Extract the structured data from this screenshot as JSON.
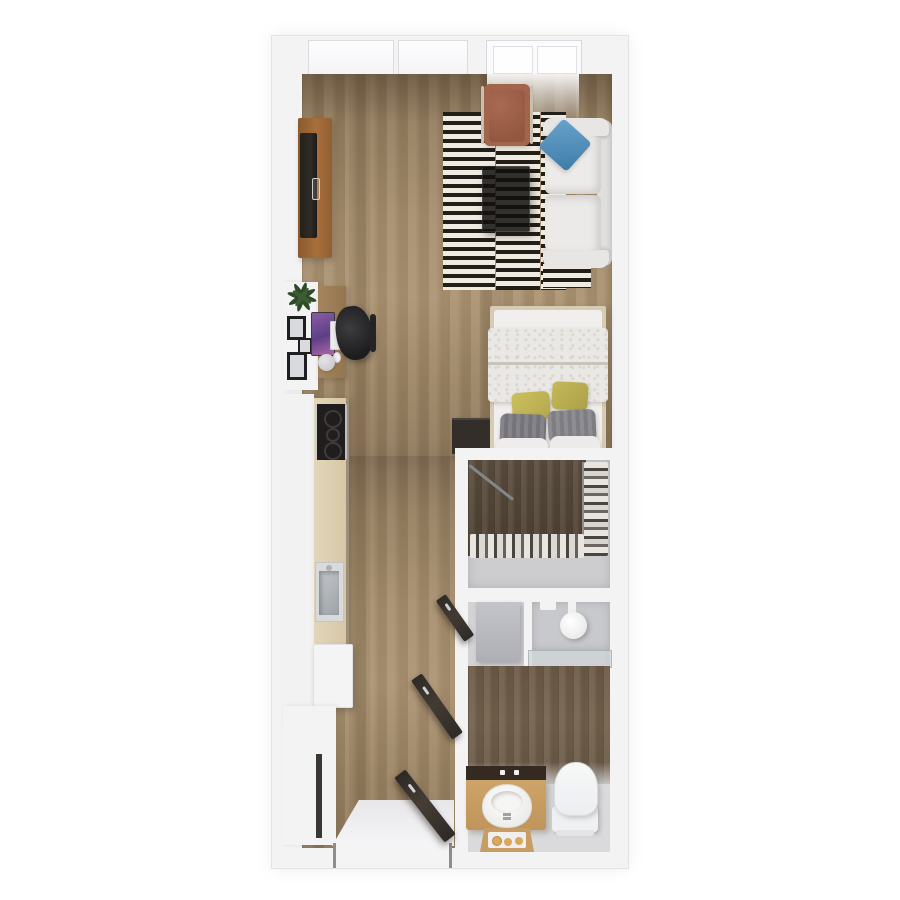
{
  "scene": {
    "kind": "3d-floor-plan-top-view",
    "description": "Top-down 3D render of a narrow studio apartment with living/sleeping area, galley kitchen, walk-in closet, bathroom and entry hall",
    "no_visible_text": true
  },
  "palette": {
    "background": "#ffffff",
    "wall": "#f4f3f4",
    "wood_floor_light": "#a08a6a",
    "wood_floor_closet": "#574a3c",
    "wood_floor_bath": "#6f5e4a",
    "gray_floor": "#d8d8da",
    "rug_stripe_dark": "#211d1a",
    "rug_stripe_light": "#f0ebe0",
    "sofa_white": "#eae9e7",
    "pillow_blue": "#5b9ac7",
    "armchair_terracotta": "#a3644c",
    "tv_console_wood": "#9c6434",
    "door_dark_brown": "#39322c",
    "vanity_wood": "#c89d63",
    "pillow_yellow": "#c0b456",
    "pillow_gray": "#85858a",
    "monitor_purple": "#7a54a0",
    "kitchen_counter_wood": "#dccdaf",
    "cooktop_black": "#201e1d",
    "washer_gray": "#b9bac0",
    "shower_tile": "#c8c9cc"
  },
  "rooms": [
    {
      "name": "living-sleeping-area",
      "items": [
        "tv-console",
        "tv",
        "black-white-striped-rug",
        "glass-coffee-table",
        "white-sofa",
        "blue-throw-pillow",
        "terracotta-armchair",
        "white-desk",
        "wood-desk-top",
        "purple-monitor",
        "white-keyboard",
        "black-office-chair",
        "desk-lamp",
        "picture-frames",
        "houseplant",
        "double-bed",
        "textured-duvet",
        "yellow-pillows",
        "gray-pillows",
        "white-pillows",
        "dark-nightstand"
      ]
    },
    {
      "name": "kitchen",
      "items": [
        "white-cabinet-run",
        "wood-counter",
        "black-cooktop",
        "stainless-sink",
        "white-refrigerator",
        "utility-cabinet"
      ]
    },
    {
      "name": "walk-in-closet",
      "items": [
        "hanging-clothes-right-rail",
        "hanging-clothes-bottom-rail",
        "leaning-clothes-pole"
      ]
    },
    {
      "name": "bathroom",
      "items": [
        "laundry-alcove-washer",
        "walk-in-shower",
        "rain-shower-head",
        "glass-partition",
        "wood-vanity",
        "white-basin-sink",
        "faucet",
        "toilet",
        "toiletry-stool"
      ]
    },
    {
      "name": "entry-hall",
      "items": [
        "entry-door-open",
        "bathroom-door-open",
        "closet-door-open",
        "entry-landing"
      ]
    }
  ],
  "windows": {
    "top_wall_pane_groups": 2,
    "total_panes": 4
  },
  "doors": {
    "count": 3,
    "style": "dark-brown-slab-open-at-angle"
  }
}
